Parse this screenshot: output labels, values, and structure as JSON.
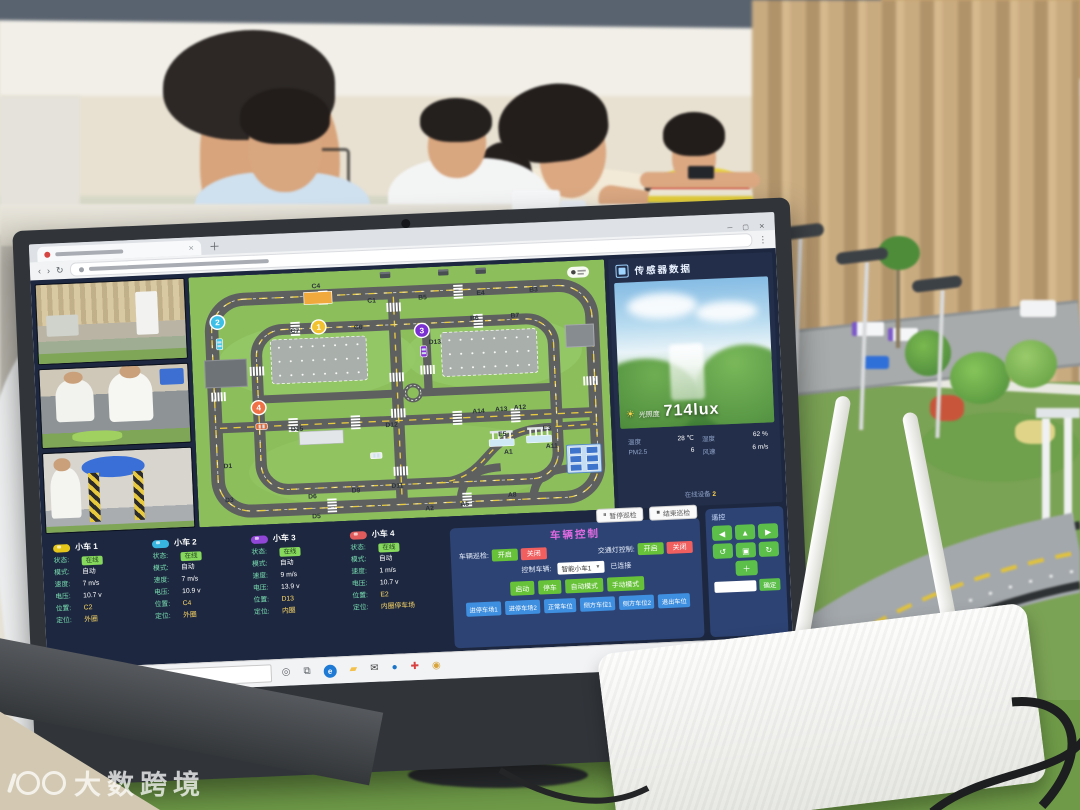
{
  "watermark": {
    "text": "大数跨境"
  },
  "screen": {
    "sensor": {
      "title": "传感器数据",
      "light_label": "光照度",
      "light_value": "714lux",
      "rows": [
        {
          "label": "温度",
          "value": "28 ℃"
        },
        {
          "label": "湿度",
          "value": "62 %"
        },
        {
          "label": "PM2.5",
          "value": "6"
        },
        {
          "label": "风速",
          "value": "6 m/s"
        }
      ],
      "footer_label": "在线设备",
      "footer_value": "2"
    },
    "control": {
      "title": "车辆控制",
      "patrol_label": "车辆巡检:",
      "traffic_light_label": "交通灯控制:",
      "on_label": "开启",
      "off_label": "关闭",
      "vehicle_select_label": "控制车辆:",
      "vehicle_select_value": "智能小车1",
      "connected_label": "已连接",
      "pause_button": "暂停巡检",
      "stop_button": "结束巡检",
      "action_buttons": [
        "启动",
        "停车",
        "自动模式",
        "手动模式"
      ],
      "parking_buttons": [
        "进停车场1",
        "进停车场2",
        "正常车位",
        "侧方车位1",
        "侧方车位2",
        "退出车位"
      ],
      "remote_label": "遥控",
      "remote_keys": [
        "◀",
        "▲",
        "▶",
        "↺",
        "▣",
        "↻"
      ],
      "remote_plus": "＋",
      "remote_send": "确定",
      "colors": {
        "on": "#67c23a",
        "off": "#f25f5f",
        "blue": "#3f8fe0"
      }
    },
    "vehicle_fields": {
      "status": "状态:",
      "mode": "模式:",
      "speed": "速度:",
      "voltage": "电压:",
      "position": "位置:",
      "loop": "定位:"
    },
    "vehicles": [
      {
        "name": "小车 1",
        "color": "#e6c619",
        "status": "在线",
        "mode": "自动",
        "speed": "7 m/s",
        "voltage": "10.7 v",
        "position": "C2",
        "loop": "外圈"
      },
      {
        "name": "小车 2",
        "color": "#37b6e0",
        "status": "在线",
        "mode": "自动",
        "speed": "7 m/s",
        "voltage": "10.9 v",
        "position": "C4",
        "loop": "外圈"
      },
      {
        "name": "小车 3",
        "color": "#9146d8",
        "status": "在线",
        "mode": "自动",
        "speed": "9 m/s",
        "voltage": "13.9 v",
        "position": "D13",
        "loop": "内圈"
      },
      {
        "name": "小车 4",
        "color": "#e05c5c",
        "status": "在线",
        "mode": "自动",
        "speed": "1 m/s",
        "voltage": "10.7 v",
        "position": "E2",
        "loop": "内圈停车场"
      }
    ],
    "map": {
      "labels": [
        {
          "t": "C4",
          "x": 122,
          "y": 16
        },
        {
          "t": "C1",
          "x": 175,
          "y": 33
        },
        {
          "t": "B5",
          "x": 224,
          "y": 32
        },
        {
          "t": "E4",
          "x": 280,
          "y": 30
        },
        {
          "t": "B3",
          "x": 331,
          "y": 29
        },
        {
          "t": "C7",
          "x": 100,
          "y": 60
        },
        {
          "t": "C6",
          "x": 161,
          "y": 59
        },
        {
          "t": "B6",
          "x": 273,
          "y": 55
        },
        {
          "t": "B7",
          "x": 312,
          "y": 54
        },
        {
          "t": "D13",
          "x": 234,
          "y": 77
        },
        {
          "t": "D15",
          "x": 98,
          "y": 158
        },
        {
          "t": "D12",
          "x": 189,
          "y": 158
        },
        {
          "t": "A14",
          "x": 273,
          "y": 148
        },
        {
          "t": "A13",
          "x": 295,
          "y": 147
        },
        {
          "t": "A12",
          "x": 313,
          "y": 146
        },
        {
          "t": "E5",
          "x": 295,
          "y": 172
        },
        {
          "t": "E3",
          "x": 338,
          "y": 168
        },
        {
          "t": "A1",
          "x": 300,
          "y": 190
        },
        {
          "t": "A11",
          "x": 342,
          "y": 186
        },
        {
          "t": "D1",
          "x": 30,
          "y": 192
        },
        {
          "t": "D3",
          "x": 30,
          "y": 226
        },
        {
          "t": "D6",
          "x": 110,
          "y": 226
        },
        {
          "t": "D9",
          "x": 152,
          "y": 222
        },
        {
          "t": "D11",
          "x": 192,
          "y": 219
        },
        {
          "t": "D5",
          "x": 113,
          "y": 246
        },
        {
          "t": "A2",
          "x": 222,
          "y": 243
        },
        {
          "t": "A5",
          "x": 256,
          "y": 240
        },
        {
          "t": "A8",
          "x": 302,
          "y": 233
        }
      ],
      "markers": [
        {
          "n": "1",
          "x": 123,
          "y": 55,
          "color": "#f2c230"
        },
        {
          "n": "2",
          "x": 26,
          "y": 46,
          "color": "#3cc0e8"
        },
        {
          "n": "3",
          "x": 222,
          "y": 63,
          "color": "#7a2fd0"
        },
        {
          "n": "4",
          "x": 62,
          "y": 133,
          "color": "#ef7146"
        }
      ],
      "cars": [
        {
          "x": 27,
          "y": 68,
          "a": 0,
          "c": "#49c8e8"
        },
        {
          "x": 223,
          "y": 84,
          "a": 0,
          "c": "#8930d8"
        },
        {
          "x": 64,
          "y": 152,
          "a": 90,
          "c": "#e8652f"
        },
        {
          "x": 173,
          "y": 186,
          "a": 90,
          "c": "#e9edf0"
        }
      ],
      "crosswalks": [
        {
          "x": 196,
          "y": 34,
          "o": "x"
        },
        {
          "x": 196,
          "y": 104,
          "o": "x"
        },
        {
          "x": 196,
          "y": 140,
          "o": "x"
        },
        {
          "x": 196,
          "y": 198,
          "o": "x"
        },
        {
          "x": 24,
          "y": 116,
          "o": "x"
        },
        {
          "x": 382,
          "y": 116,
          "o": "x"
        },
        {
          "x": 62,
          "y": 92,
          "o": "x"
        },
        {
          "x": 226,
          "y": 98,
          "o": "x"
        },
        {
          "x": 90,
          "y": 152,
          "o": "y"
        },
        {
          "x": 150,
          "y": 152,
          "o": "y"
        },
        {
          "x": 248,
          "y": 152,
          "o": "y"
        },
        {
          "x": 304,
          "y": 152,
          "o": "y"
        },
        {
          "x": 124,
          "y": 26,
          "o": "y"
        },
        {
          "x": 254,
          "y": 26,
          "o": "y"
        },
        {
          "x": 124,
          "y": 234,
          "o": "y"
        },
        {
          "x": 254,
          "y": 234,
          "o": "y"
        },
        {
          "x": 96,
          "y": 56,
          "o": "y"
        },
        {
          "x": 272,
          "y": 56,
          "o": "y"
        }
      ]
    },
    "taskbar": {
      "search_placeholder": "在此输入进行搜索",
      "icons": [
        {
          "name": "cortana-icon",
          "glyph": "◎",
          "color": "#5f6368",
          "bg": ""
        },
        {
          "name": "task-view-icon",
          "glyph": "⧉",
          "color": "#5f6368",
          "bg": ""
        },
        {
          "name": "edge-icon",
          "glyph": "e",
          "color": "#ffffff",
          "bg": "#1e7ad4"
        },
        {
          "name": "folder-icon",
          "glyph": "▰",
          "color": "#f3c14b",
          "bg": ""
        },
        {
          "name": "mail-icon",
          "glyph": "✉",
          "color": "#454545",
          "bg": ""
        },
        {
          "name": "onedrive-icon",
          "glyph": "●",
          "color": "#1b74c8",
          "bg": ""
        },
        {
          "name": "pin-icon",
          "glyph": "✚",
          "color": "#d84040",
          "bg": ""
        },
        {
          "name": "browser-icon",
          "glyph": "◉",
          "color": "#d8a43c",
          "bg": ""
        }
      ]
    }
  }
}
